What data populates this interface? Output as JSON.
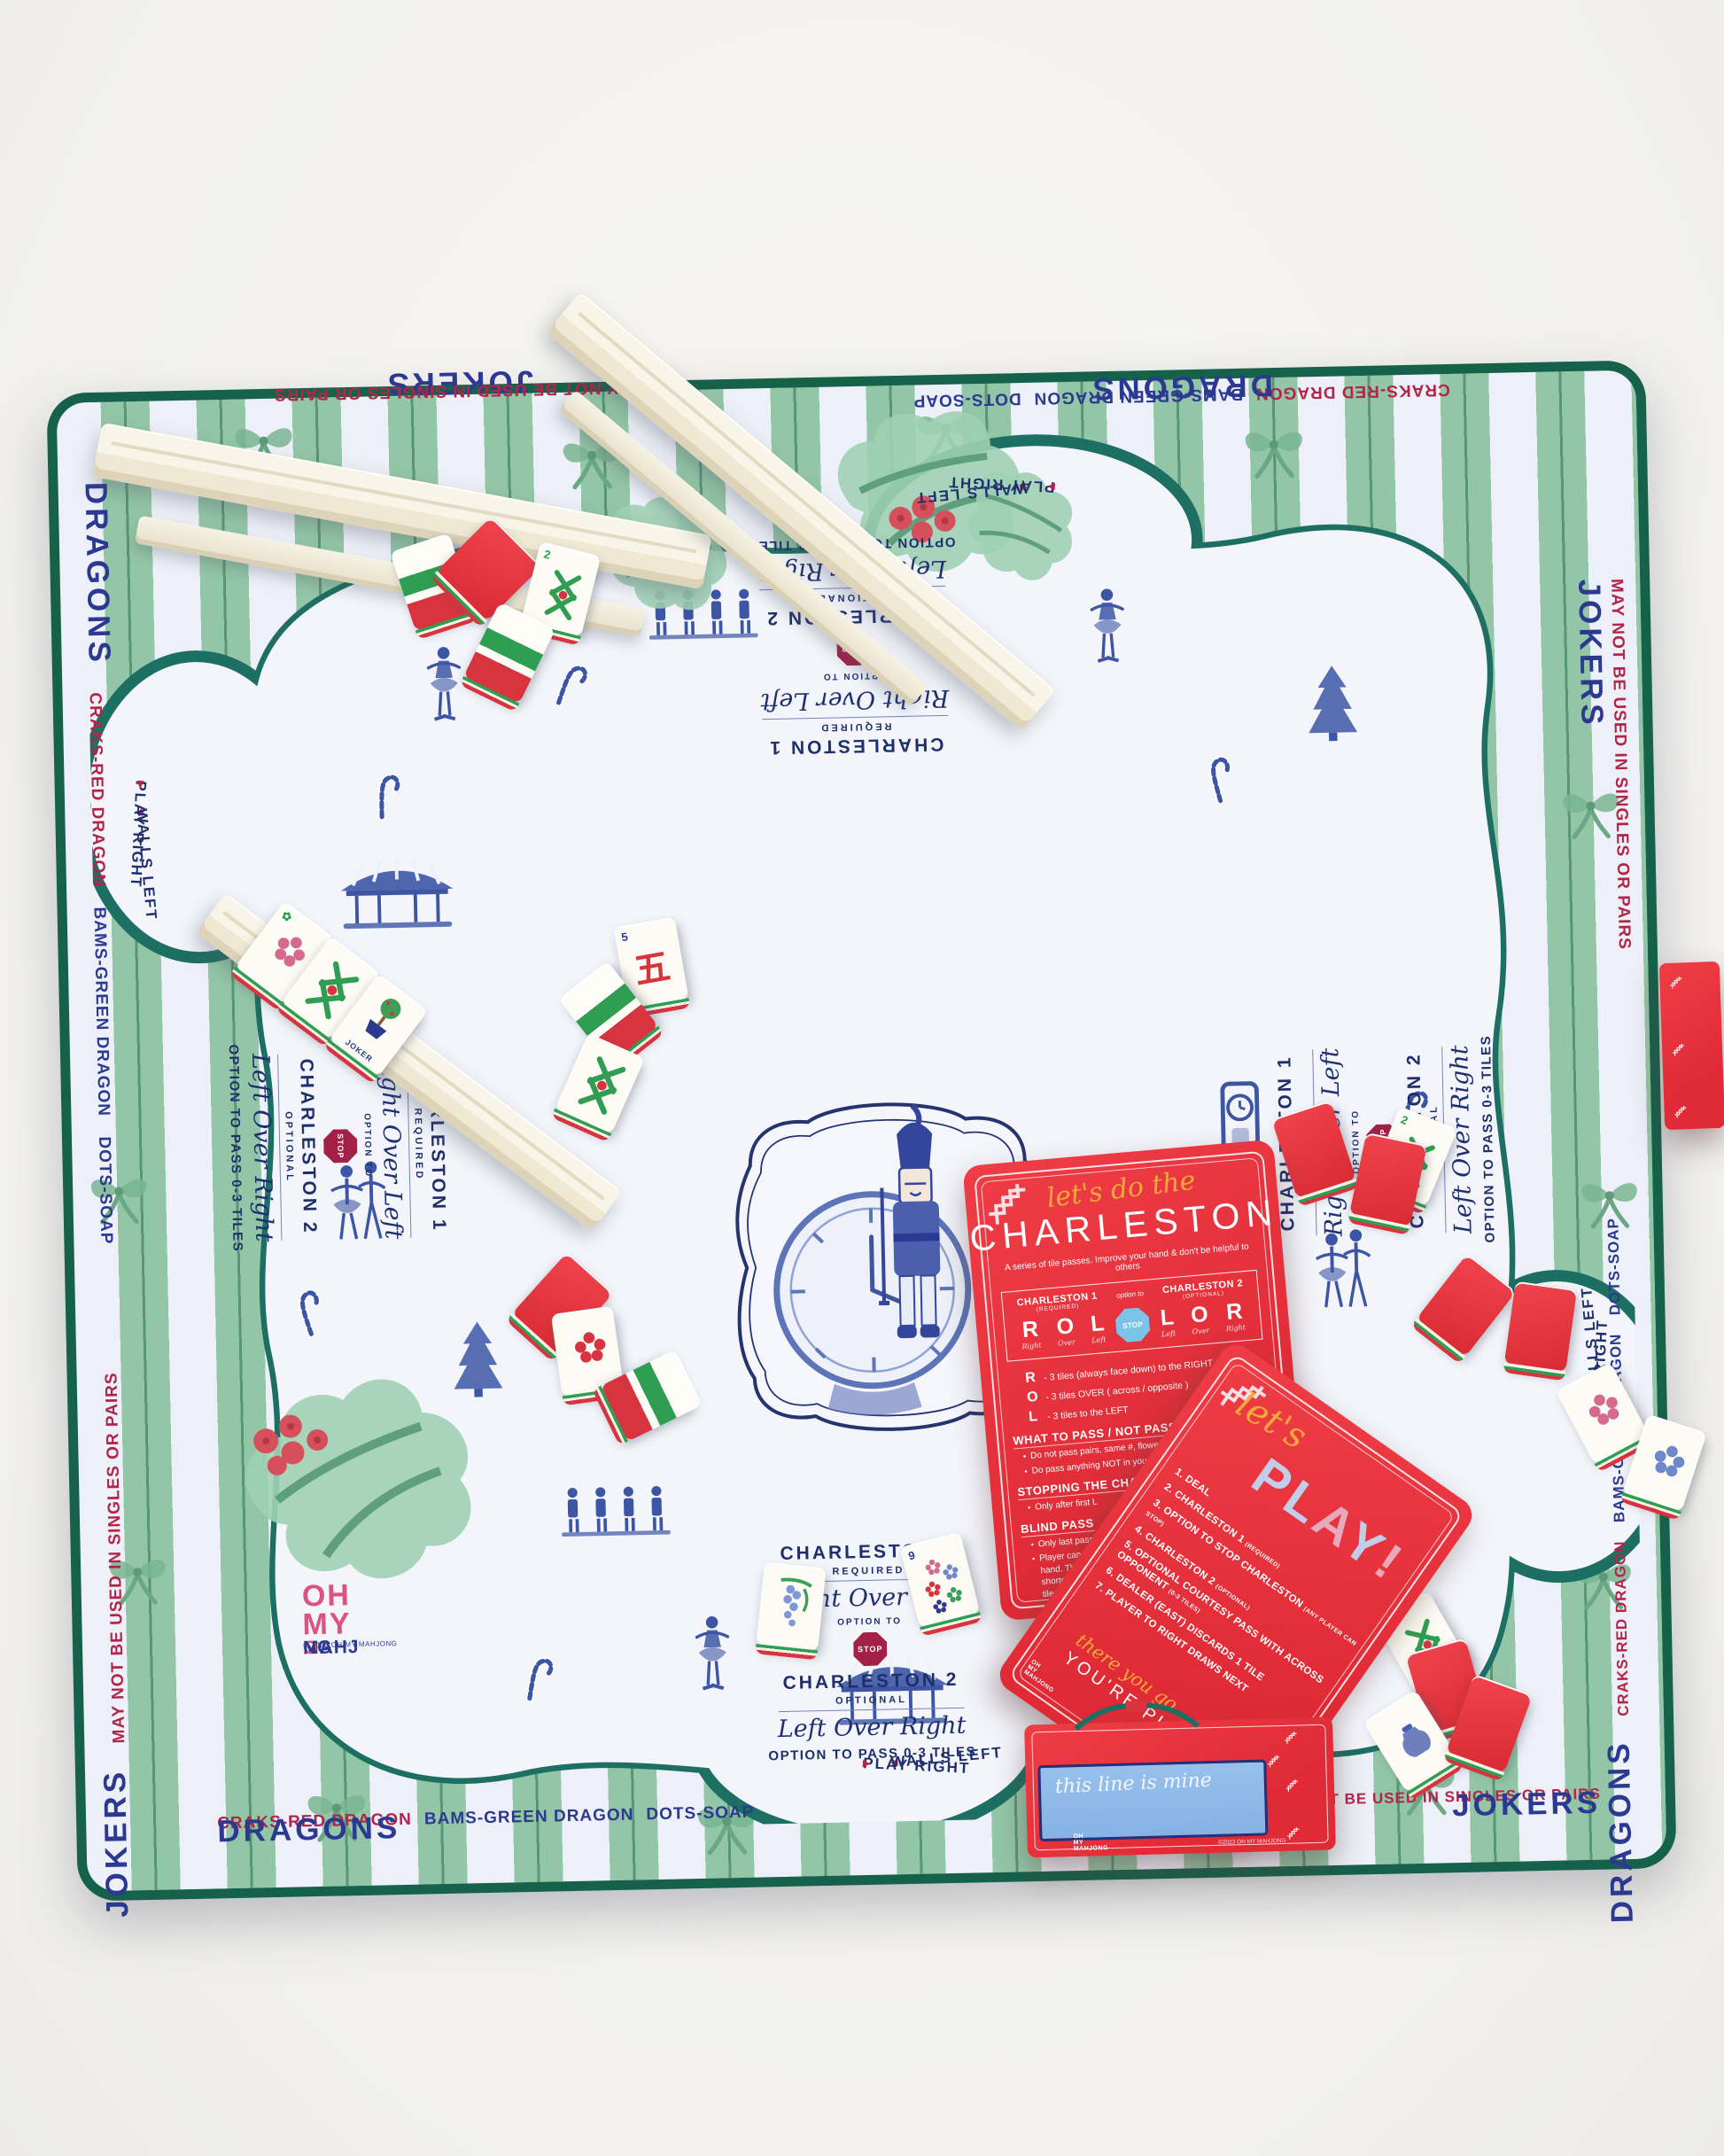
{
  "colors": {
    "mat_stripe_green": "#93c6a6",
    "mat_edge_green": "#15614a",
    "scallop_teal": "#1d6f63",
    "toile_blue": "#3c56a5",
    "label_navy": "#2b3990",
    "label_red": "#b22448",
    "card_red": "#e8333f",
    "script_gold": "#f2a93b",
    "logo_pink": "#dd5380",
    "stop_maroon": "#a32147",
    "stop_blue": "#7cc3e9",
    "name_strip_blue": "#8fbae9"
  },
  "mat": {
    "border": {
      "jokers": "JOKERS",
      "jokers_note": "MAY NOT BE USED IN SINGLES OR PAIRS",
      "dragons": "DRAGONS",
      "craks": "CRAKS-RED DRAGON",
      "bams": "BAMS-GREEN DRAGON",
      "dots": "DOTS-SOAP"
    },
    "instructions": {
      "c1": "CHARLESTON 1",
      "c1_sub": "REQUIRED",
      "c1_script": "Right Over Left",
      "option_to": "OPTION TO",
      "stop": "STOP",
      "c2": "CHARLESTON 2",
      "c2_sub": "OPTIONAL",
      "c2_script": "Left Over Right",
      "pass": "OPTION TO PASS 0-3 TILES"
    },
    "directions": {
      "play_right": "PLAY RIGHT",
      "walls_left": "WALLS LEFT",
      "right_arrow": "▸",
      "left_arrow": "◂"
    },
    "logo": {
      "l1": "OH",
      "l2": "MY",
      "l3_m": "MAHJ",
      "l3_o": "O",
      "l3_ng": "NG",
      "copyright": "© 2023 OH MY MAHJONG"
    }
  },
  "charleston_card": {
    "script_header": "let's do the",
    "title": "CHARLESTON",
    "subtitle": "A series of tile passes. Improve your hand & don't be helpful to others",
    "box": {
      "c1": "CHARLESTON 1",
      "c1_sub": "(REQUIRED)",
      "option_to": "option to",
      "stop": "STOP",
      "c2": "CHARLESTON 2",
      "c2_sub": "(OPTIONAL)",
      "left_letters": [
        "R",
        "O",
        "L"
      ],
      "left_words": [
        "Right",
        "Over",
        "Left"
      ],
      "right_letters": [
        "L",
        "O",
        "R"
      ],
      "right_words": [
        "Left",
        "Over",
        "Right"
      ]
    },
    "legend": [
      {
        "letter": "R",
        "text": "- 3 tiles (always face down) to the RIGHT"
      },
      {
        "letter": "O",
        "text": "- 3 tiles OVER ( across / opposite )"
      },
      {
        "letter": "L",
        "text": "- 3 tiles to the LEFT"
      }
    ],
    "what_heading": "WHAT TO PASS / NOT PASS",
    "what_b1": "Do not pass pairs, same #, flowers, dragons or jokers",
    "what_b2": "Do pass anything NOT in your longest & strongest suits",
    "stop_heading": "STOPPING THE CHARLESTON",
    "stop_b1": "Only after first L",
    "blind_heading": "BLIND PASS",
    "blind_b1": "Only last pass of each Charleston (R)",
    "blind_b2": "Player can choose to pass 0-3 unwanted tiles from their hand. Then, player can use received tiles to make up for any shortcomings. Just remember you must ultimately pass 3 tiles!"
  },
  "play_card": {
    "script_header": "let's",
    "title_p": "P",
    "title_l": "L",
    "title_a": "A",
    "title_y": "Y",
    "title_x": "!",
    "steps": [
      {
        "num": "1.",
        "text": "DEAL",
        "note": ""
      },
      {
        "num": "2.",
        "text": "CHARLESTON 1",
        "note": "(REQUIRED)"
      },
      {
        "num": "3.",
        "text": "OPTION TO STOP CHARLESTON",
        "note": "(ANY PLAYER CAN STOP)"
      },
      {
        "num": "4.",
        "text": "CHARLESTON 2",
        "note": "(OPTIONAL)"
      },
      {
        "num": "5.",
        "text": "OPTIONAL COURTESY PASS WITH ACROSS OPPONENT",
        "note": "(0-3 TILES)"
      },
      {
        "num": "6.",
        "text": "DEALER (EAST) DISCARDS 1 TILE",
        "note": ""
      },
      {
        "num": "7.",
        "text": "PLAYER TO RIGHT DRAWS NEXT",
        "note": ""
      }
    ],
    "script_footer": "there you go",
    "footer": "YOU'RE PLAY"
  },
  "name_card": {
    "script": "this line is mine",
    "copyright": "©2023 OH MY MAHJONG",
    "logo_l1": "OH",
    "logo_l2": "MY",
    "logo_l3": "MAHJONG"
  },
  "tiles": {
    "joker": "JOKER",
    "crak_number": "5",
    "crak_character": "五",
    "bam_two": "2",
    "bam_four": "4",
    "flower_nine": "9"
  }
}
